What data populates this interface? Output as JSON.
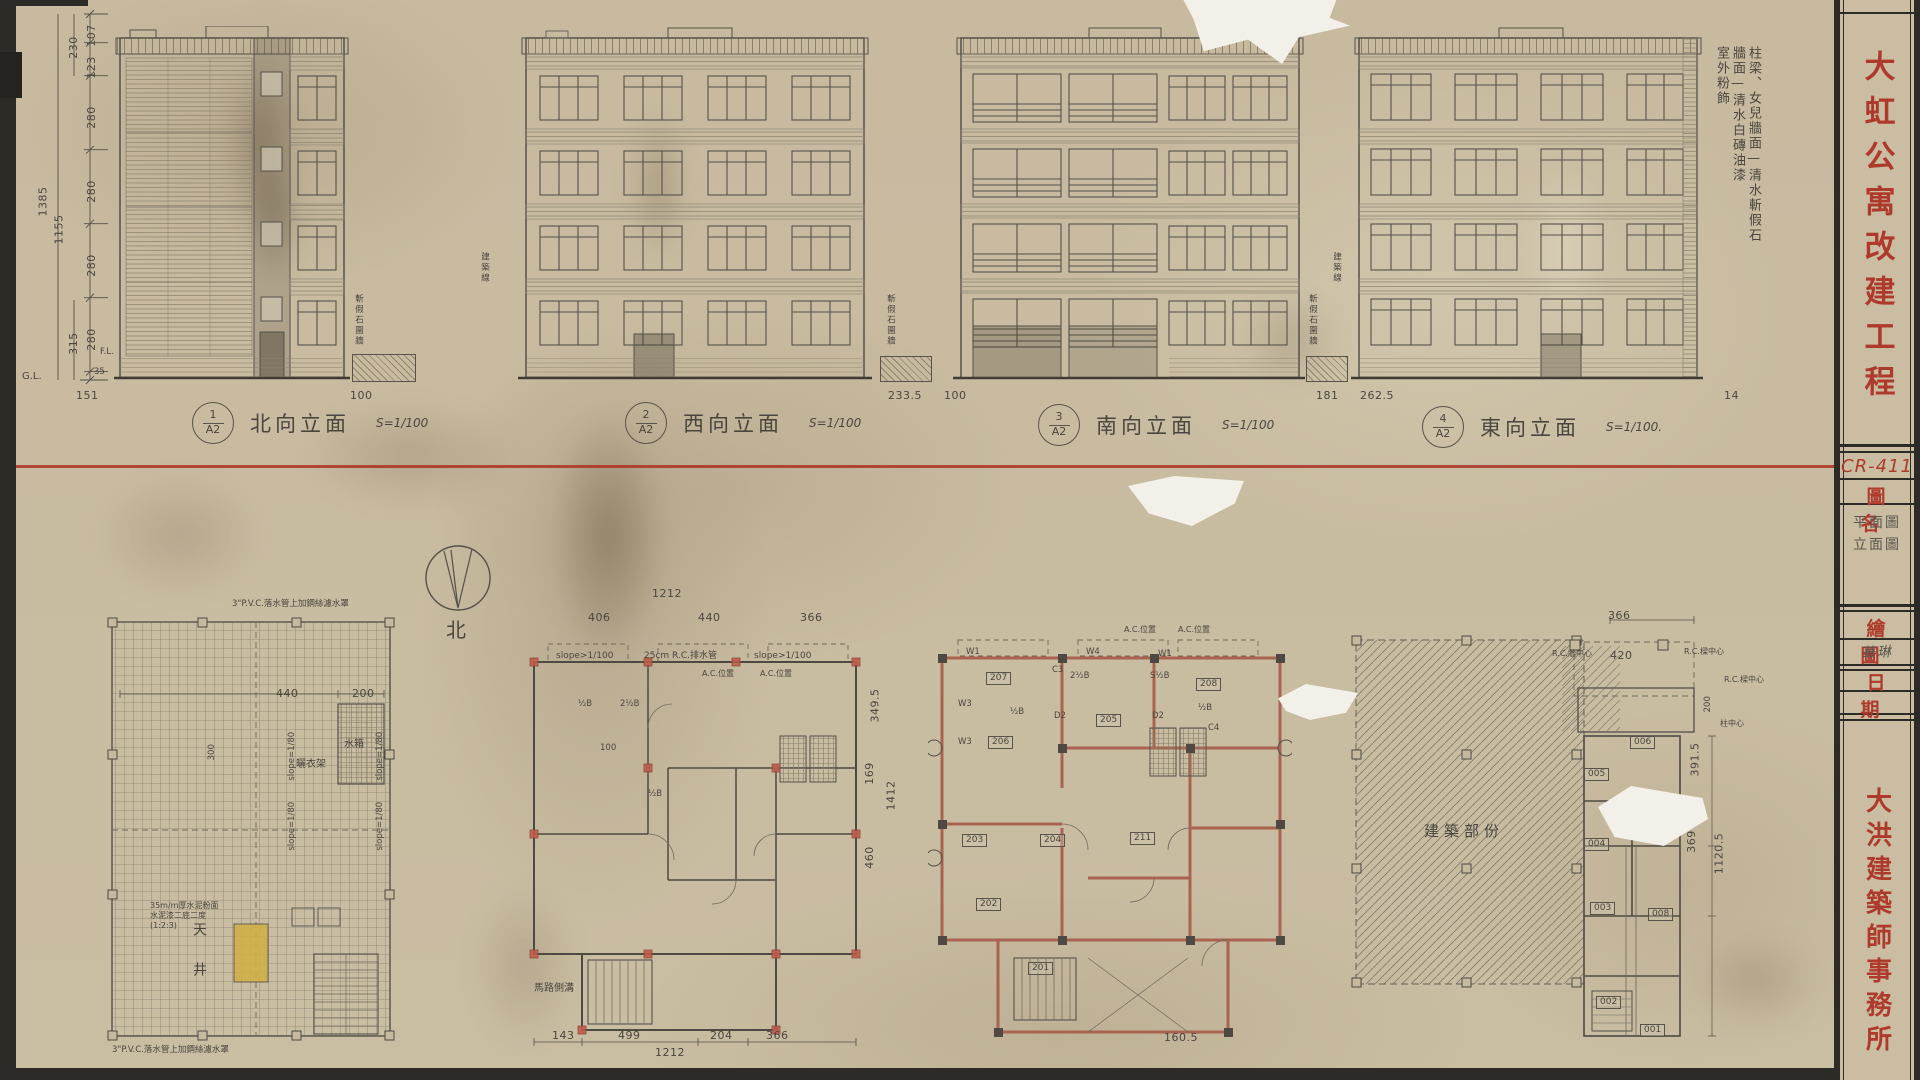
{
  "titleblock": {
    "project": "大虹公寓改建工程",
    "code": "CR-411",
    "name_label": "圖名",
    "name_line1": "平面圖",
    "name_line2": "立面圖",
    "drawn_label": "繪圖",
    "drawn_value": "華琳",
    "date_label": "日期",
    "firm": "大洪建築師事務所"
  },
  "finish_notes": {
    "col1": "柱梁、女兒牆面—清水斬假石",
    "col2": "牆面—清水白磚油漆",
    "col3": "室外粉飾"
  },
  "elevations": [
    {
      "num": "1",
      "ref": "A2",
      "title": "北向立面",
      "scale": "S=1/100"
    },
    {
      "num": "2",
      "ref": "A2",
      "title": "西向立面",
      "scale": "S=1/100"
    },
    {
      "num": "3",
      "ref": "A2",
      "title": "南向立面",
      "scale": "S=1/100"
    },
    {
      "num": "4",
      "ref": "A2",
      "title": "東向立面",
      "scale": "S=1/100."
    }
  ],
  "left_dims": {
    "s1": "107",
    "s2": "123",
    "s3": "280",
    "s4": "280",
    "s5": "280",
    "s6": "280",
    "s7": "35",
    "sub1": "230",
    "sub2": "315",
    "total1": "1385",
    "total2": "1155",
    "gl": "G.L.",
    "fl": "F.L."
  },
  "ground_dims": {
    "d1": "151",
    "d2": "100",
    "d3": "233.5",
    "d4": "100",
    "d5": "181",
    "d6": "262.5",
    "d7": "14"
  },
  "site": {
    "building_line": "建築線",
    "fence": "斬假石圍牆",
    "north": "北"
  },
  "roof_plan": {
    "downspout_note": "3\"P.V.C.落水管上加鋼絲濾水罩",
    "finish1": "35m/m厚水泥粉面",
    "finish2": "水泥漆二底二度",
    "finish3": "(1:2:3)",
    "drying_rack": "曬衣架",
    "water_tank": "水箱",
    "lightwell": "天井",
    "d440": "440",
    "d200": "200",
    "d300": "300",
    "slope": "slope=1/80"
  },
  "plan2": {
    "top_total": "1212",
    "t1": "406",
    "t2": "440",
    "t3": "366",
    "b1": "143",
    "b2": "499",
    "b3": "204",
    "b4": "366",
    "bottom_total": "1212",
    "r1": "349.5",
    "r2": "169",
    "r3": "460",
    "right_total": "1412",
    "slope": "slope>1/100",
    "drain": "25cm R.C.排水管",
    "ac": "A.C.位置",
    "gutter": "馬路側溝",
    "halfb": "½B",
    "twohalfb": "2½B",
    "d100": "100"
  },
  "plan3": {
    "r201": "201",
    "r202": "202",
    "r203": "203",
    "r204": "204",
    "r205": "205",
    "r206": "206",
    "r207": "207",
    "r208": "208",
    "r211": "211",
    "w1": "W1",
    "w3": "W3",
    "w4": "W4",
    "c3": "C3",
    "c4": "C4",
    "d2": "D2",
    "halfb": "½B",
    "twohalfb": "2½B",
    "shalfb": "S½B",
    "ac": "A.C.位置",
    "d160": "160.5"
  },
  "plan4": {
    "label": "建築部份"
  },
  "plan5": {
    "r001": "001",
    "r002": "002",
    "r003": "003",
    "r004": "004",
    "r005": "005",
    "r006": "006",
    "r008": "008",
    "d366": "366",
    "d420": "420",
    "d200": "200",
    "d391": "391.5",
    "d369": "369",
    "d1120": "1120.5",
    "d90": "90",
    "d180": "180",
    "wall_cl": "R.C.牆中心",
    "beam_cl": "R.C.樑中心",
    "col_cl": "柱中心"
  }
}
